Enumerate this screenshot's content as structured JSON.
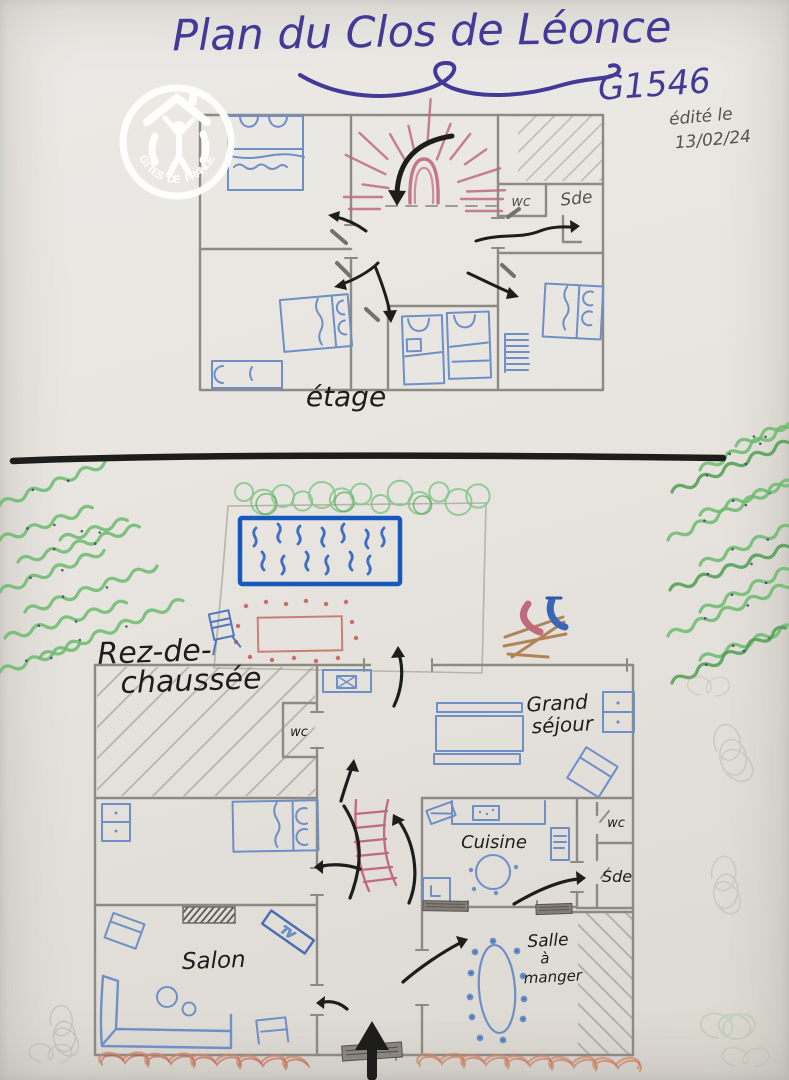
{
  "header": {
    "title": "Plan du Clos de Léonce",
    "code": "G1546",
    "edited_line1": "édité le",
    "edited_line2": "13/02/24"
  },
  "logo": {
    "name": "GÎTES DE FRANCE"
  },
  "upper_floor": {
    "label": "étage",
    "wc": "wc",
    "sde": "Sde"
  },
  "ground_floor": {
    "label_line1": "Rez-de-",
    "label_line2": "chaussée",
    "hall_wc": "wc",
    "living_line1": "Grand",
    "living_line2": "séjour",
    "kitchen": "Cuisine",
    "wc": "wc",
    "sde": "Sde",
    "lounge": "Salon",
    "tv": "TV",
    "dining_line1": "Salle",
    "dining_line2": "à",
    "dining_line3": "manger"
  },
  "colors": {
    "ink": "#433a97",
    "pencil": "#8d8a84",
    "blue": "#6f8fc7",
    "pool": "#1559be",
    "pink": "#c06a7e",
    "green": "#6cbb6e",
    "brown": "#b08455",
    "black": "#1d1d1b",
    "orange": "#cc7a5a",
    "paper": "#e8e5e0"
  }
}
